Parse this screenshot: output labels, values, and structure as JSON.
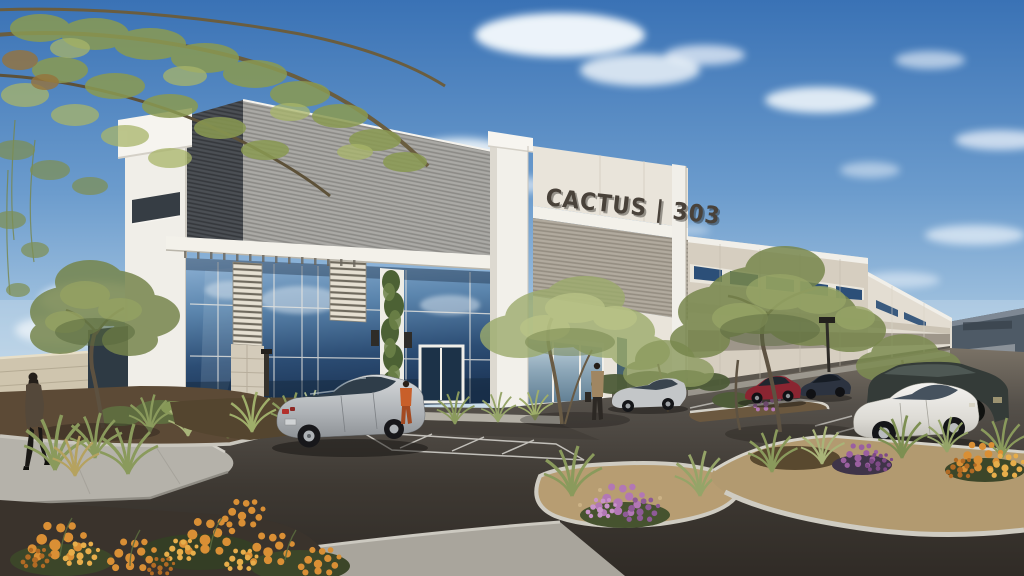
{
  "building": {
    "sign_text": "CACTUS | 303",
    "description": "single-story tilt-up industrial office building, white and gray ribbed metal entry feature with tall glass curtain wall, beige concrete panels with blue ribbon windows on the long elevation",
    "sign_color": "#49423a",
    "accent_colors": {
      "white_trim": "#f1efe9",
      "ribbed_gray": "#aaa9a5",
      "ribbed_dark": "#4b4f54",
      "panel_beige": "#d6cec0",
      "window_blue": "#2c4f78",
      "glass_blue": "#2c4d74"
    }
  },
  "scene": {
    "sky": "clear blue sky with scattered white clouds",
    "ground": "dark asphalt drive and parking with concrete curbed desert planting islands",
    "vehicles": [
      "silver sedan parked at entry",
      "silver compact sedan near corner",
      "dark red sedan",
      "navy sedan",
      "white sedan",
      "dark SUV"
    ],
    "people": [
      "woman in dark coat walking on left sidewalk",
      "person in orange outfit at entrance",
      "person in tan jacket standing near storefront"
    ],
    "landscape": [
      "overhanging palo verde branches top left",
      "desert olive trees",
      "ornamental grass tufts",
      "orange flowering shrubs",
      "purple flowering shrubs",
      "gravel and bark mulch islands",
      "cream block screen wall"
    ]
  },
  "palette": {
    "sky_top": "#3a72b5",
    "sky_horizon": "#cfe0ec",
    "asphalt_dark": "#332e29",
    "concrete": "#b5b2aa",
    "foliage_olive": "#76854c",
    "flower_orange": "#d98f35",
    "flower_purple": "#b277b5"
  }
}
